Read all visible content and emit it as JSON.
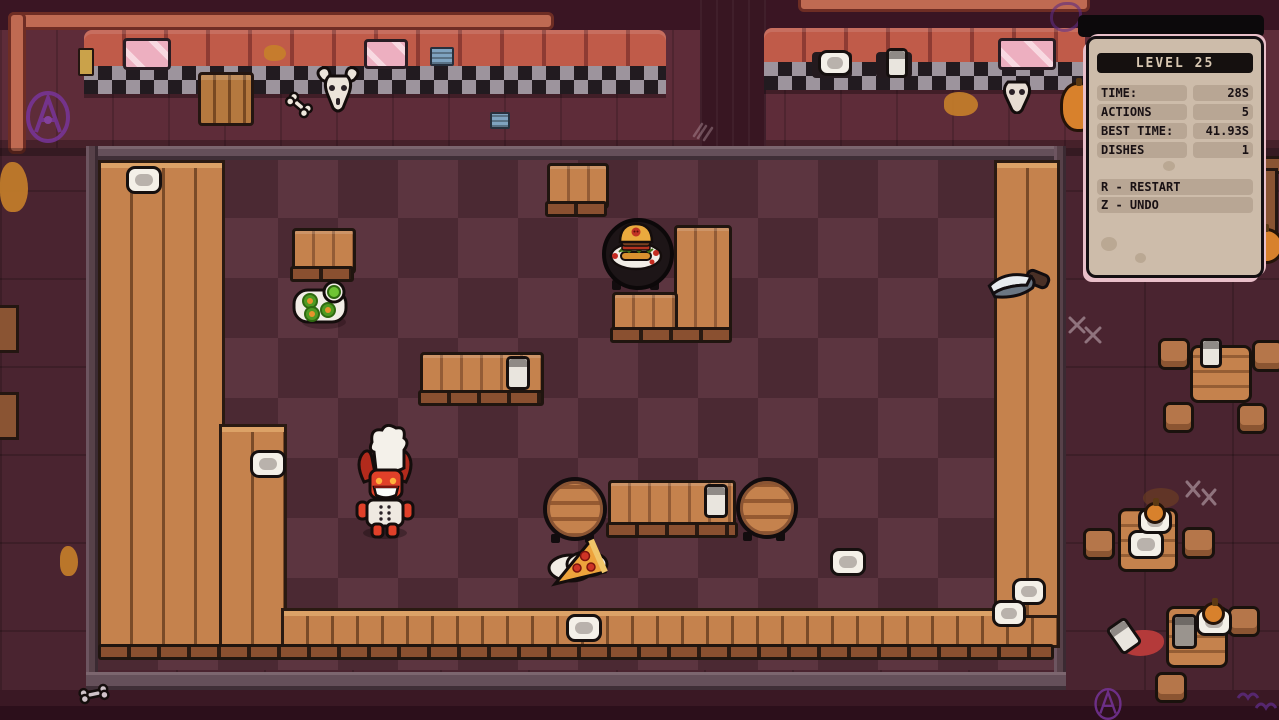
{
  "hud": {
    "level_label": "LEVEL 25",
    "stats": [
      {
        "label": "TIME:",
        "value": "28S"
      },
      {
        "label": "ACTIONS",
        "value": "5"
      },
      {
        "label": "BEST TIME:",
        "value": "41.93S"
      },
      {
        "label": "DISHES",
        "value": "1"
      }
    ],
    "controls": [
      {
        "label": "R - RESTART"
      },
      {
        "label": "Z - UNDO"
      }
    ]
  },
  "colors": {
    "floor_tile_light": "#5c3540",
    "floor_tile_dark": "#4b2933",
    "wood": "#c5824d",
    "wall": "#5e2c39",
    "booth_seat": "#c05b49",
    "hud_panel": "#cdbcaa",
    "hud_strip": "#b8a694",
    "hud_accent_pink": "#e9bfc9",
    "devil_red": "#e04029",
    "graffiti_purple": "#7a35a0"
  },
  "scene": {
    "player": "devil-chef",
    "foods": [
      "burger-on-round-table",
      "green-dish-plate",
      "pizza-slice-on-plate"
    ],
    "props": [
      "knife",
      "bull-skull",
      "skull",
      "bone",
      "wooden-crate",
      "pink-windows",
      "blue-vents",
      "dishes",
      "cups",
      "benches",
      "barrel-tables",
      "square-tables",
      "stools",
      "pumpkins",
      "spilled-drink",
      "graffiti",
      "scratch-marks"
    ]
  }
}
